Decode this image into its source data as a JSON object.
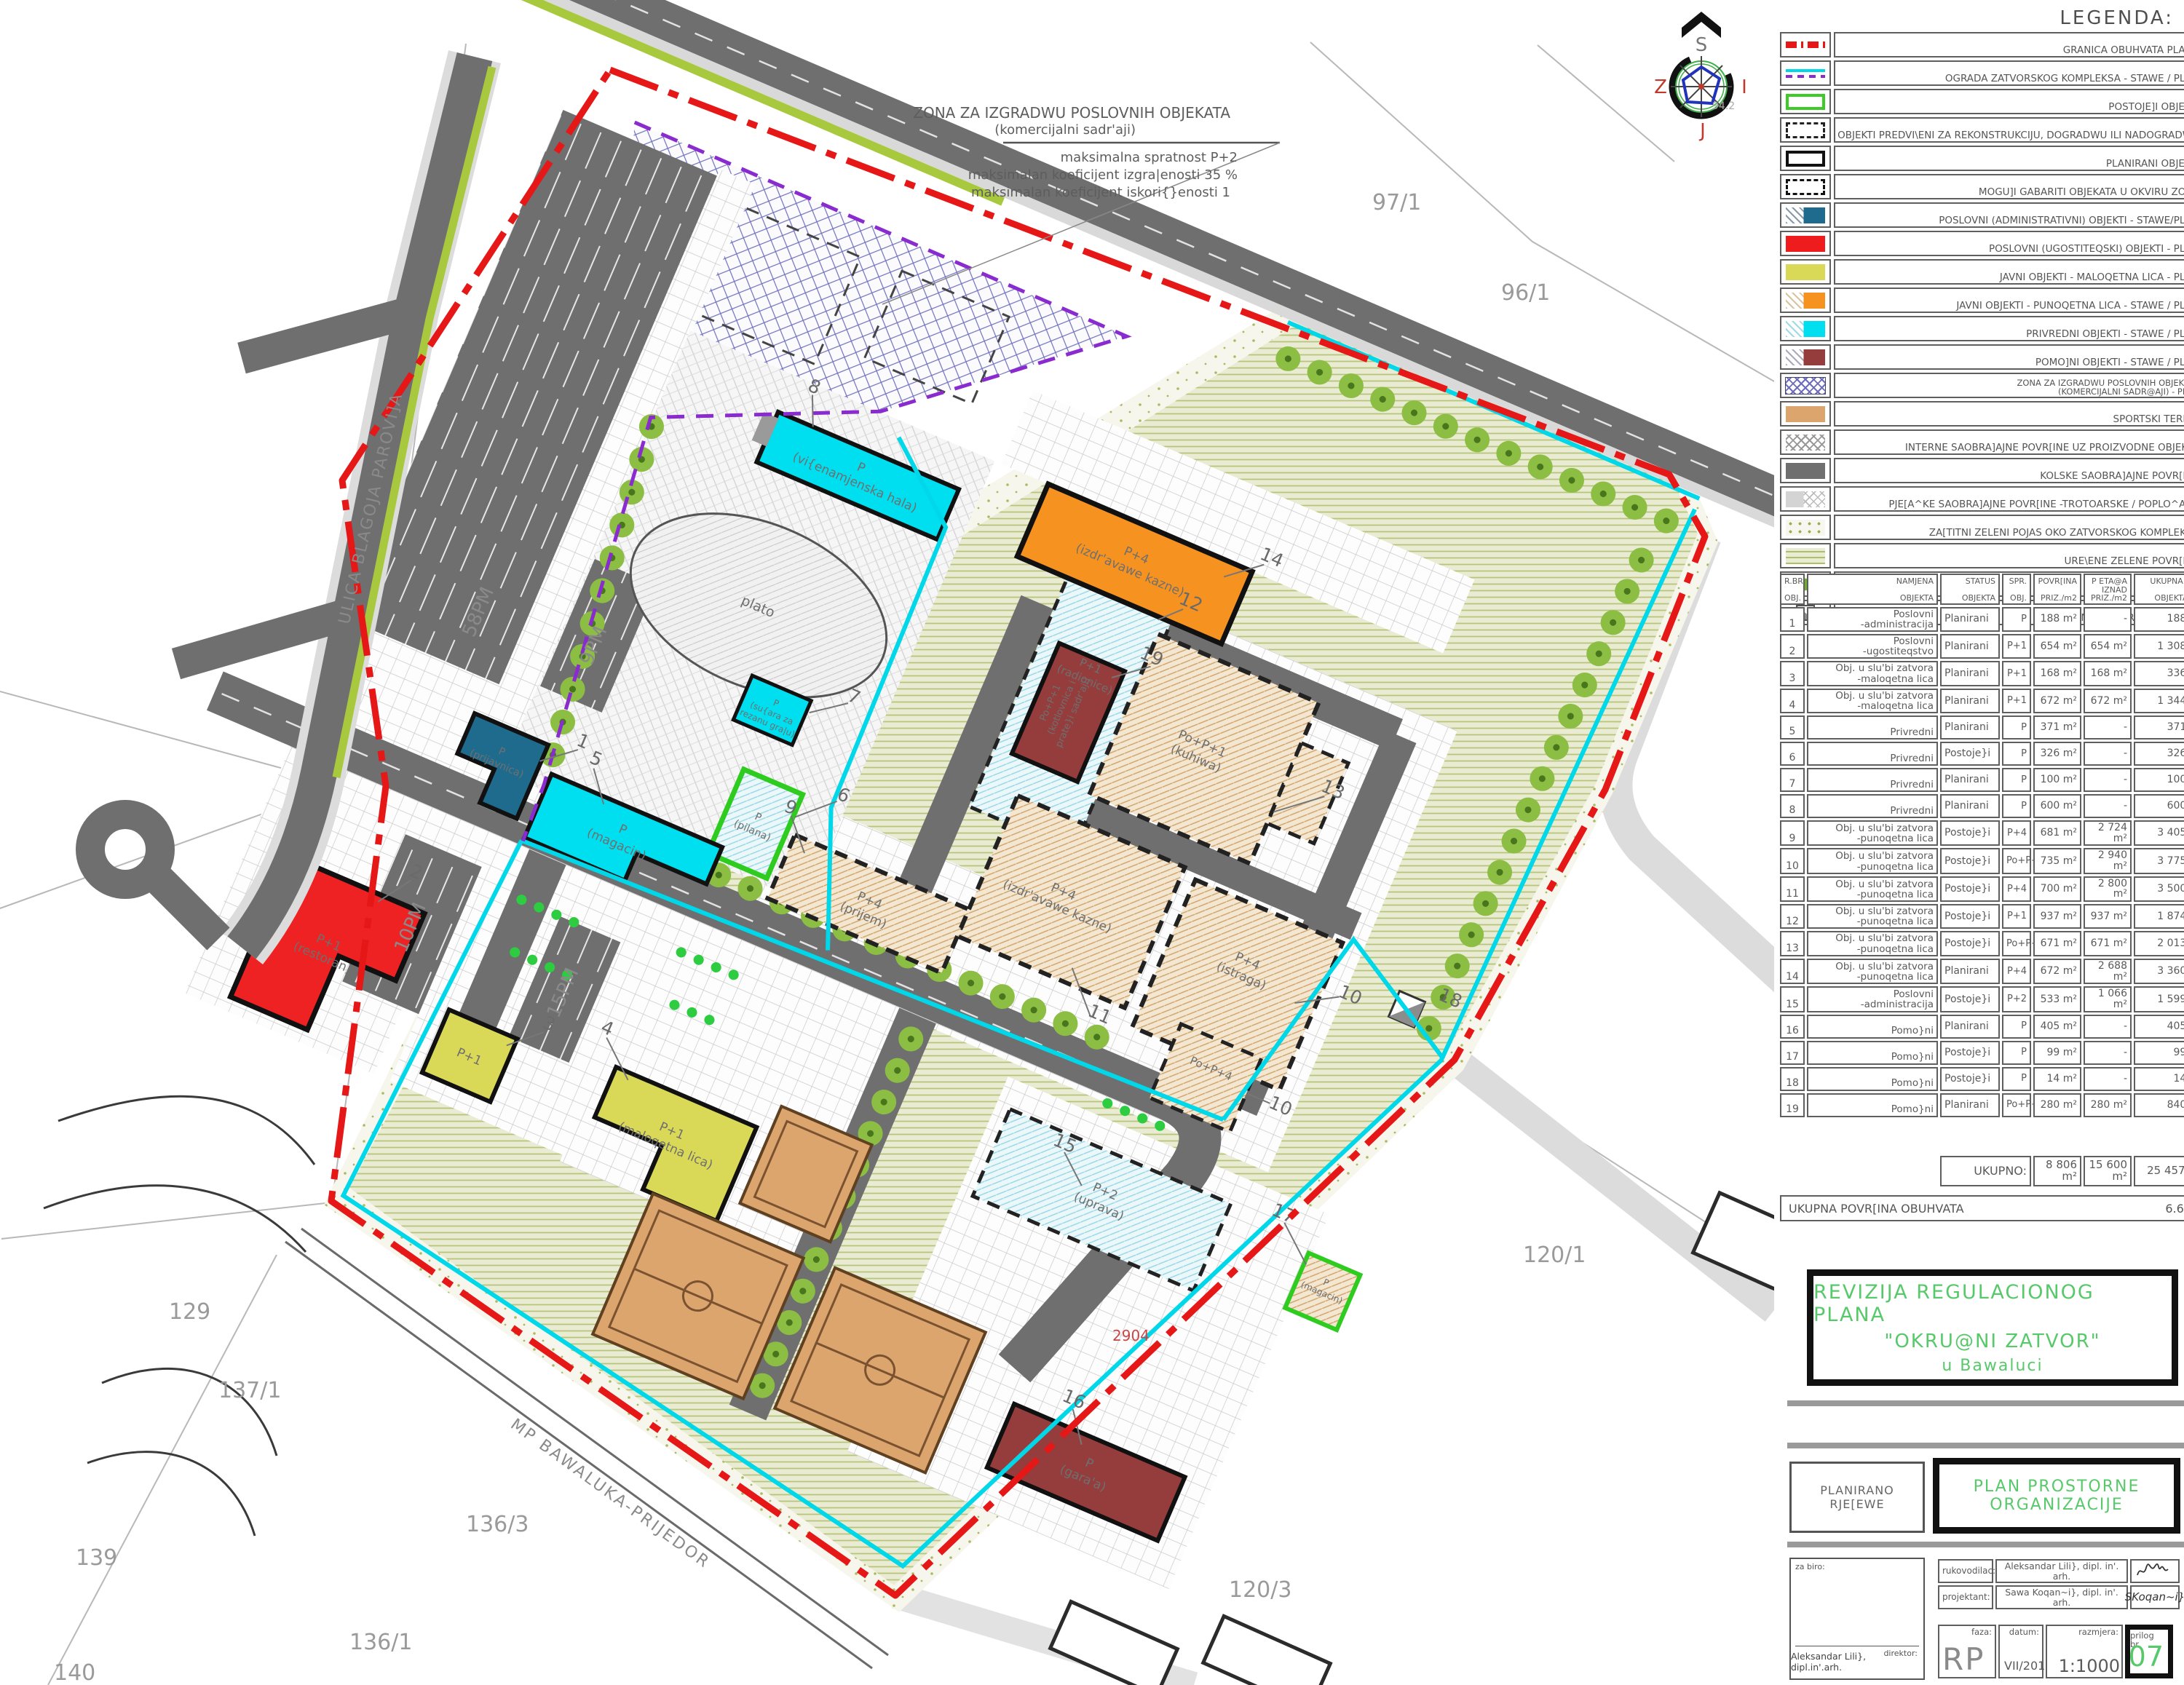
{
  "colors": {
    "accent_green": "#57c96a",
    "boundary_red": "#e51717",
    "fence_cyan": "#00d8ea",
    "ograda_purple": "#8a2bd0",
    "road_gray": "#6f6f6f"
  },
  "legend": {
    "title": "LEGENDA:",
    "items": [
      {
        "sw": "granica",
        "label": "GRANICA OBUHVATA PLANA"
      },
      {
        "sw": "ograda",
        "label": "OGRADA ZATVORSKOG KOMPLEKSA - STAWE / PLAN"
      },
      {
        "sw": "postojeci",
        "label": "POSTOJE]I OBJEKTI"
      },
      {
        "sw": "rekon",
        "label": "OBJEKTI PREDVI\\ENI ZA REKONSTRUKCIJU, DOGRADWU ILI NADOGRADWU"
      },
      {
        "sw": "planirani",
        "label": "PLANIRANI OBJEKTI"
      },
      {
        "sw": "gabariti",
        "label": "MOGU]I GABARITI OBJEKATA U OKVIRU ZONE"
      },
      {
        "sw": "adm",
        "label": "POSLOVNI (ADMINISTRATIVNI) OBJEKTI - STAWE/PLAN"
      },
      {
        "sw": "ugost",
        "label": "POSLOVNI (UGOSTITEQSKI) OBJEKTI  - PLAN"
      },
      {
        "sw": "maloqetna",
        "label": "JAVNI OBJEKTI - MALOQETNA LICA  - PLAN"
      },
      {
        "sw": "punoqetna",
        "label": "JAVNI OBJEKTI - PUNOQETNA LICA - STAWE / PLAN"
      },
      {
        "sw": "privredni",
        "label": "PRIVREDNI OBJEKTI - STAWE / PLAN"
      },
      {
        "sw": "pomocni",
        "label": "POMO]NI OBJEKTI - STAWE / PLAN"
      },
      {
        "sw": "zona",
        "label": "ZONA ZA IZGRADWU POSLOVNIH OBJEKATA",
        "label2": "(KOMERCIJALNI SADR@AJI) - PLAN"
      },
      {
        "sw": "sport",
        "label": "SPORTSKI TERENI"
      },
      {
        "sw": "interne",
        "label": "INTERNE SAOBRA]AJNE POVR[INE UZ PROIZVODNE OBJEKTE"
      },
      {
        "sw": "kolske",
        "label": "KOLSKE SAOBRA]AJNE POVR[INE"
      },
      {
        "sw": "pjesacke",
        "label": "PJE[A^KE SAOBRA]AJNE POVR[INE -TROTOARSKE / POPLO^ANE"
      },
      {
        "sw": "zastitni",
        "label": "ZA[TITNI ZELENI POJAS OKO ZATVORSKOG KOMPLEKSA"
      },
      {
        "sw": "uredjene",
        "label": "URE\\ENE ZELENE POVR[INE"
      },
      {
        "sw": "drvoredi",
        "label": "DRVOREDI"
      },
      {
        "sw": "trafo",
        "label": "PLANIRANA TRAFO STANICA"
      }
    ]
  },
  "table": {
    "headers": [
      [
        "R.BR",
        "OBJ."
      ],
      [
        "NAMJENA",
        "OBJEKTA"
      ],
      [
        "STATUS",
        "OBJEKTA"
      ],
      [
        "SPR.",
        "OBJ."
      ],
      [
        "POVR[INA",
        "PRIZ./m2"
      ],
      [
        "P ETA@A",
        "IZNAD PRIZ./m2"
      ],
      [
        "UKUPNA POV.",
        "OBJEKTA/m2"
      ]
    ],
    "rows": [
      {
        "num": "1",
        "n1": "Poslovni",
        "n2": "-administracija",
        "status": "Planirani",
        "spr": "P",
        "pov": "188 m²",
        "eta": "-",
        "uk": "188 m²"
      },
      {
        "num": "2",
        "n1": "Poslovni",
        "n2": "-ugostiteqstvo",
        "status": "Planirani",
        "spr": "P+1",
        "pov": "654 m²",
        "eta": "654 m²",
        "uk": "1 308 m²"
      },
      {
        "num": "3",
        "n1": "Obj. u slu'bi zatvora",
        "n2": "-maloqetna lica",
        "status": "Planirani",
        "spr": "P+1",
        "pov": "168 m²",
        "eta": "168 m²",
        "uk": "336 m²"
      },
      {
        "num": "4",
        "n1": "Obj. u slu'bi zatvora",
        "n2": "-maloqetna lica",
        "status": "Planirani",
        "spr": "P+1",
        "pov": "672 m²",
        "eta": "672 m²",
        "uk": "1 344 m²"
      },
      {
        "num": "5",
        "n1": "Privredni",
        "n2": "",
        "status": "Planirani",
        "spr": "P",
        "pov": "371 m²",
        "eta": "-",
        "uk": "371 m²"
      },
      {
        "num": "6",
        "n1": "Privredni",
        "n2": "",
        "status": "Postoje}i",
        "spr": "P",
        "pov": "326 m²",
        "eta": "-",
        "uk": "326 m²"
      },
      {
        "num": "7",
        "n1": "Privredni",
        "n2": "",
        "status": "Planirani",
        "spr": "P",
        "pov": "100 m²",
        "eta": "-",
        "uk": "100 m²"
      },
      {
        "num": "8",
        "n1": "Privredni",
        "n2": "",
        "status": "Planirani",
        "spr": "P",
        "pov": "600 m²",
        "eta": "-",
        "uk": "600 m²"
      },
      {
        "num": "9",
        "n1": "Obj. u slu'bi zatvora",
        "n2": "-punoqetna lica",
        "status": "Postoje}i",
        "spr": "P+4",
        "pov": "681 m²",
        "eta": "2 724 m²",
        "uk": "3 405 m²"
      },
      {
        "num": "10",
        "n1": "Obj. u slu'bi zatvora",
        "n2": "-punoqetna lica",
        "status": "Postoje}i",
        "spr": "Po+P+4",
        "pov": "735 m²",
        "eta": "2 940 m²",
        "uk": "3 775 m²"
      },
      {
        "num": "11",
        "n1": "Obj. u slu'bi zatvora",
        "n2": "-punoqetna lica",
        "status": "Postoje}i",
        "spr": "P+4",
        "pov": "700 m²",
        "eta": "2 800 m²",
        "uk": "3 500 m²"
      },
      {
        "num": "12",
        "n1": "Obj. u slu'bi zatvora",
        "n2": "-punoqetna lica",
        "status": "Postoje}i",
        "spr": "P+1",
        "pov": "937 m²",
        "eta": "937 m²",
        "uk": "1 874 m²"
      },
      {
        "num": "13",
        "n1": "Obj. u slu'bi zatvora",
        "n2": "-punoqetna lica",
        "status": "Postoje}i",
        "spr": "Po+P+1",
        "pov": "671 m²",
        "eta": "671 m²",
        "uk": "2 013 m²"
      },
      {
        "num": "14",
        "n1": "Obj. u slu'bi zatvora",
        "n2": "-punoqetna lica",
        "status": "Planirani",
        "spr": "P+4",
        "pov": "672 m²",
        "eta": "2 688 m²",
        "uk": "3 360 m²"
      },
      {
        "num": "15",
        "n1": "Poslovni",
        "n2": "-administracija",
        "status": "Postoje}i",
        "spr": "P+2",
        "pov": "533 m²",
        "eta": "1 066 m²",
        "uk": "1 599 m²"
      },
      {
        "num": "16",
        "n1": "Pomo}ni",
        "n2": "",
        "status": "Planirani",
        "spr": "P",
        "pov": "405 m²",
        "eta": "-",
        "uk": "405 m²"
      },
      {
        "num": "17",
        "n1": "Pomo}ni",
        "n2": "",
        "status": "Postoje}i",
        "spr": "P",
        "pov": "99 m²",
        "eta": "-",
        "uk": "99 m²"
      },
      {
        "num": "18",
        "n1": "Pomo}ni",
        "n2": "",
        "status": "Postoje}i",
        "spr": "P",
        "pov": "14 m²",
        "eta": "-",
        "uk": "14 m²"
      },
      {
        "num": "19",
        "n1": "Pomo}ni",
        "n2": "",
        "status": "Planirani",
        "spr": "Po+P+1",
        "pov": "280 m²",
        "eta": "280 m²",
        "uk": "840 m²"
      }
    ],
    "totals": {
      "label": "UKUPNO:",
      "pov": "8 806 m²",
      "eta": "15 600 m²",
      "uk": "25 457 m²"
    },
    "area": {
      "label": "UKUPNA POVR[INA OBUHVATA",
      "value": "6.61 ha"
    }
  },
  "title_block": {
    "title1": "REVIZIJA REGULACIONOG PLANA",
    "title2": "\"OKRU@NI ZATVOR\"",
    "title3": "u Bawaluci",
    "left1": "PLANIRANO",
    "left2": "RJE[EWE",
    "right1": "PLAN PROSTORNE",
    "right2": "ORGANIZACIJE",
    "za_biro": "za biro:",
    "direktor_label": "direktor:",
    "direktor": "Aleksandar Lili}, dipl.in'.arh.",
    "rukovodilac_label": "rukovodilac:",
    "rukovodilac": "Aleksandar Lili}, dipl. in'. arh.",
    "projektant_label": "projektant:",
    "projektant": "Sawa Koqan~i}, dipl. in'. arh.",
    "projektant_sig": "SKoqan~i}",
    "faza_label": "faza:",
    "faza": "RP",
    "datum_label": "datum:",
    "datum": "VII/2011.",
    "razmjera_label": "razmjera:",
    "razmjera": "1:1000",
    "prilog_label": "prilog br.",
    "prilog": "07"
  },
  "map": {
    "zone_note": {
      "l1": "ZONA ZA IZGRADWU POSLOVNIH OBJEKATA",
      "l2": "(komercijalni sadr'aji)",
      "l3": "maksimalna spratnost P+2",
      "l4": "maksimalan koeficijent izgra|enosti 35 %",
      "l5": "maksimalan koeficijent iskori{}enosti 1"
    },
    "street": "ULICA BLAGOJA PAROVI]A",
    "railway": "MP BAWALUKA-PRIJEDOR",
    "compass": {
      "n": "S",
      "w": "Z",
      "e": "I",
      "s": "J",
      "elev": "94.2"
    },
    "parcels": {
      "p97_1": "97/1",
      "p96_1": "96/1",
      "p129": "129",
      "p137_1": "137/1",
      "p136_3": "136/3",
      "p136_1": "136/1",
      "p139": "139",
      "p140": "140",
      "p120_1": "120/1",
      "p120_3": "120/3",
      "p2904": "2904"
    },
    "parking": {
      "pm58": "58PM",
      "pm9": "9PM",
      "pm10": "10PM",
      "pm15": "15PM"
    },
    "buildings": {
      "b1": {
        "num": "1",
        "l1": "P",
        "l2": "(prijavnica)"
      },
      "b2": {
        "num": "2",
        "l1": "P+1",
        "l2": "(restoran)"
      },
      "b3": {
        "num": "3",
        "l1": "P+1"
      },
      "b4": {
        "num": "4",
        "l1": "P+1",
        "l2": "(maloqetna lica)"
      },
      "b5": {
        "num": "5",
        "l1": "P",
        "l2": "(magacin)"
      },
      "b6": {
        "num": "6",
        "l1": "P",
        "l2": "(pilana)"
      },
      "b7": {
        "num": "7",
        "l1": "P",
        "l2": "(su{ara za",
        "l3": "rezanu gra|u)"
      },
      "b8": {
        "num": "8",
        "l1": "P",
        "l2": "(vi{enamjenska hala)"
      },
      "b9": {
        "num": "9",
        "l1": "P+4",
        "l2": "(prijem)"
      },
      "b10": {
        "num": "10",
        "l1": "P+4",
        "l2": "(istraga)"
      },
      "b10b": {
        "num": "10",
        "l1": "Po+P+4"
      },
      "b11": {
        "num": "11",
        "l1": "P+4",
        "l2": "(izdr'avawe kazne)"
      },
      "b12": {
        "num": "12",
        "l1": "P+1",
        "l2": "(radionice)"
      },
      "b13": {
        "num": "13",
        "l1": "Po+P+1",
        "l2": "(kuhiwa)"
      },
      "b14": {
        "num": "14",
        "l1": "P+4",
        "l2": "(izdr'avawe kazne)"
      },
      "b15": {
        "num": "15",
        "l1": "P+2",
        "l2": "(uprava)"
      },
      "b16": {
        "num": "16",
        "l1": "P",
        "l2": "(gara'a)"
      },
      "b17": {
        "num": "17",
        "l1": "P",
        "l2": "(magacin)"
      },
      "b18": {
        "num": "18"
      },
      "b19": {
        "num": "19",
        "l1": "Po+P+1",
        "l2": "(kotlovnica i",
        "l3": "prate}i sadr'aji)"
      },
      "plato": "plato"
    }
  }
}
